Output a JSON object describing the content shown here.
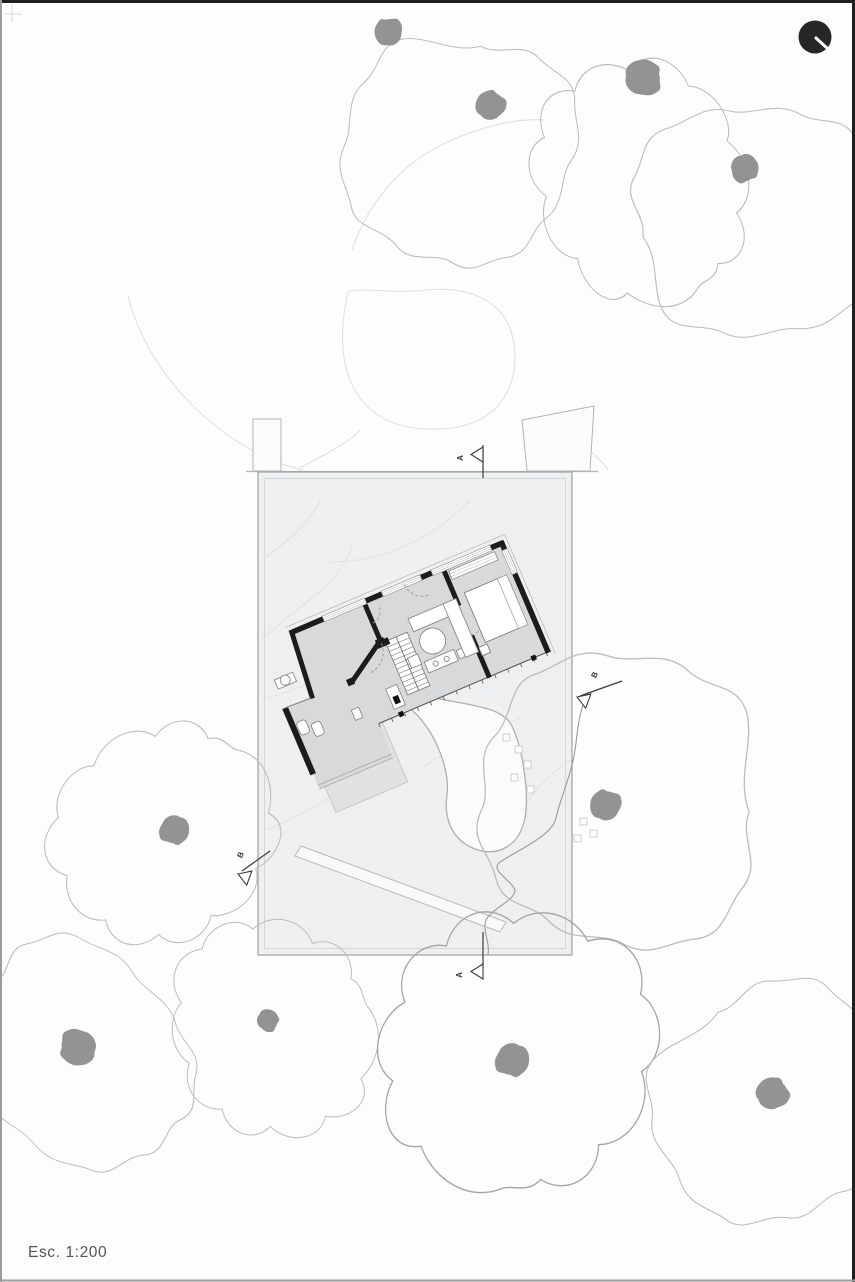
{
  "drawing": {
    "type": "architectural-site-plan",
    "scale_label": "Esc. 1:200"
  },
  "sections": {
    "a_top": "A",
    "a_bottom": "A",
    "b_left": "B",
    "b_right": "B"
  },
  "north": {
    "symbol": "north-indicator-circle"
  },
  "colors": {
    "paper": "#fdfdfd",
    "frame_dark": "#1f1f1f",
    "frame_light": "#9c9c9c",
    "lot_fill": "#edeff0",
    "lot_edge": "#9aa0a2",
    "lot_inner_edge": "#d2d5d6",
    "contour": "#dfe3e4",
    "floor_fill": "#d8d9da",
    "wall_ink": "#1c1c1c",
    "fixture_line": "#8a8a8a",
    "canopy_line": "#bdbdbd",
    "canopy_line_dark": "#a6a6a6",
    "trunk_fill": "#919395",
    "marker_ink": "#3a3a3a",
    "label_ink": "#565656",
    "north_fill": "#262626"
  }
}
